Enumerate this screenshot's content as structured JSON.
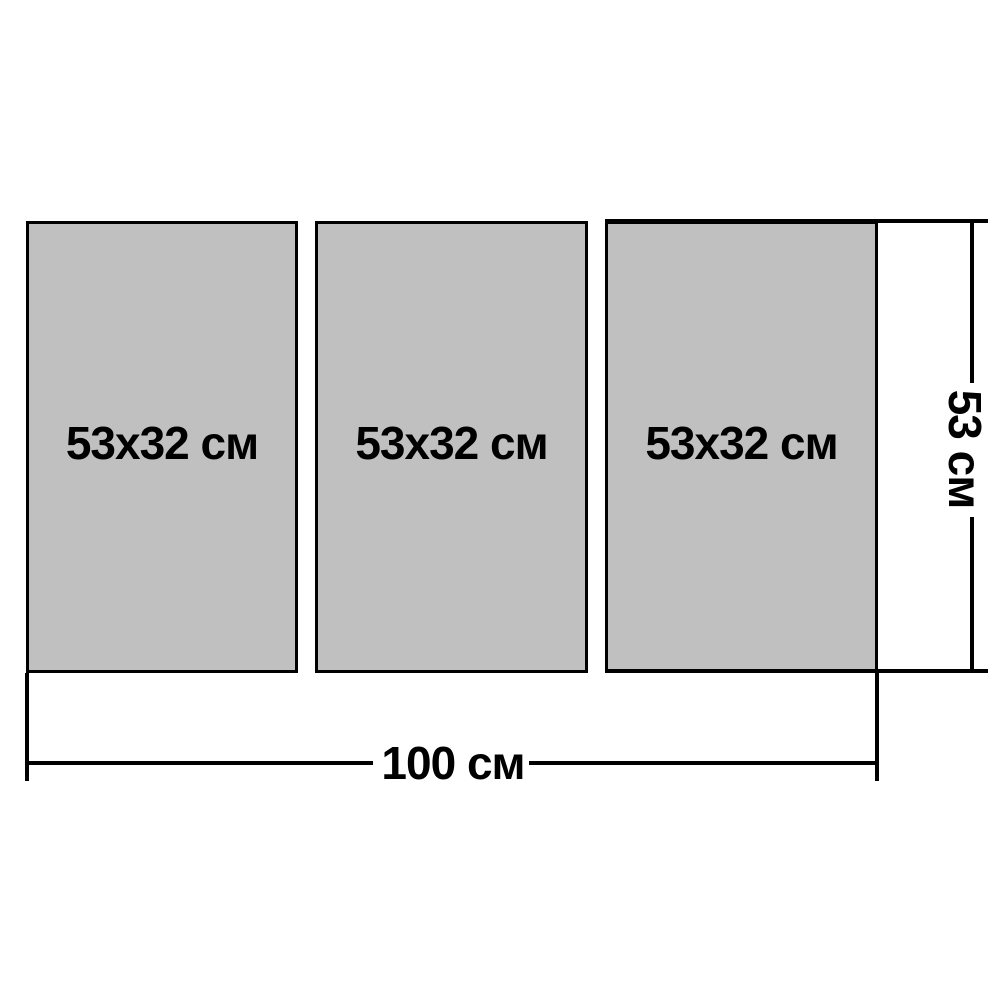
{
  "diagram": {
    "description": "Modular picture size diagram with three equal panels",
    "panels": [
      {
        "label": "53x32 см"
      },
      {
        "label": "53x32 см"
      },
      {
        "label": "53x32 см"
      }
    ],
    "width_dimension": {
      "label": "100 см"
    },
    "height_dimension": {
      "label": "53 см"
    },
    "colors": {
      "panel_fill": "#c0c0c0",
      "line": "#000000",
      "background": "#ffffff"
    }
  }
}
